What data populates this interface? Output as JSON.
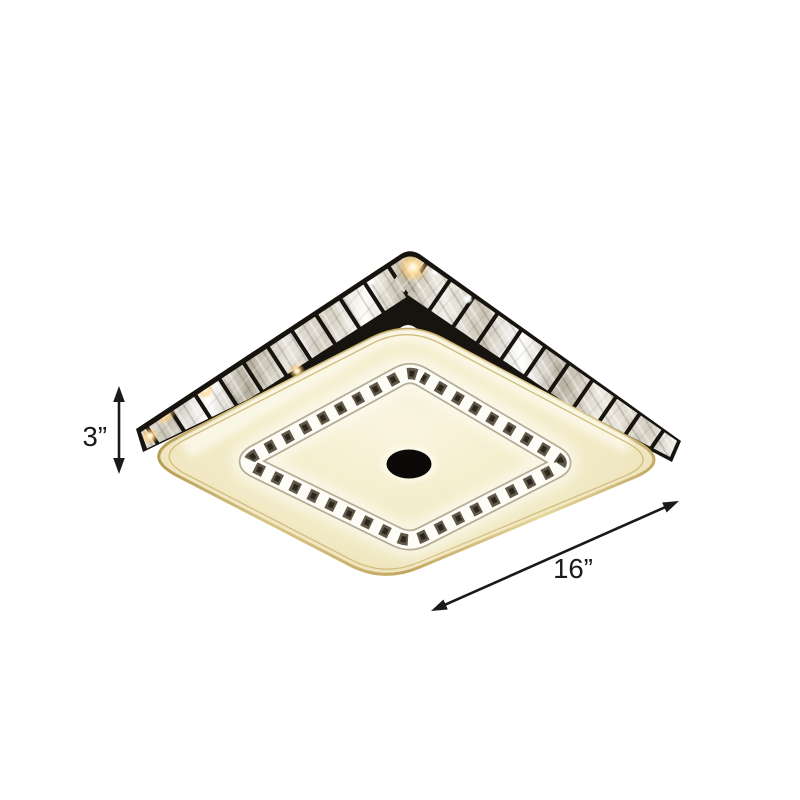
{
  "page": {
    "background": "#ffffff",
    "kind": "product dimension illustration"
  },
  "product": {
    "name": "square-crystal-flush-mount-ceiling-light",
    "description": "Square LED flush mount ceiling light seen from below at an angle: black-framed clear-crystal side band, cream/gold diffuser face with gold rim, inset square ring of small crystals and a black round center cap",
    "colors": {
      "background": "#ffffff",
      "shade_cream": "#f2ebc8",
      "shade_glow": "#faf6e2",
      "rim_gold": "#c5a965",
      "band_black": "#17130e",
      "crystal_light": "#eceae3",
      "crystal_shadow": "#b7b0a0",
      "sparkle_warm": "#ffd88d",
      "ring_cell_white": "#fdfcf6",
      "ring_crystal_dark": "#57503f",
      "center_cap_black": "#0b0a08",
      "annotation": "#1a1a1a"
    }
  },
  "annotations": {
    "height": {
      "label": "3”",
      "value_inches": 3,
      "orientation": "vertical"
    },
    "width": {
      "label": "16”",
      "value_inches": 16,
      "orientation": "diagonal"
    }
  }
}
